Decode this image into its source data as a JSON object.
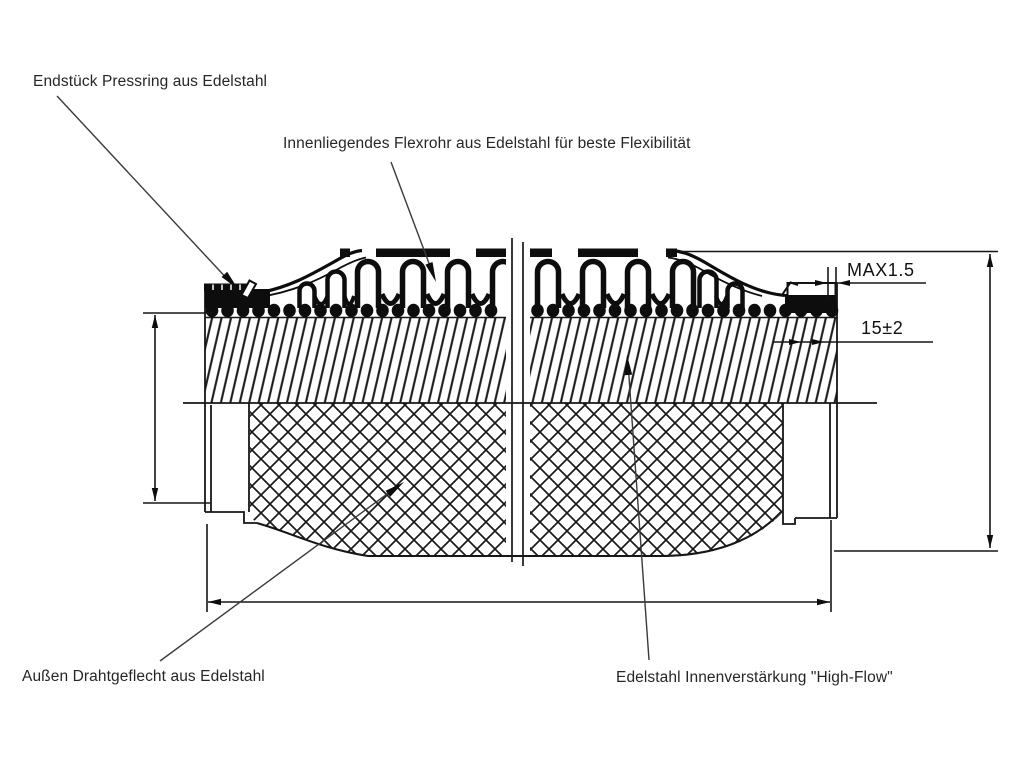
{
  "labels": {
    "pressring": "Endstück Pressring aus Edelstahl",
    "flexrohr": "Innenliegendes Flexrohr aus Edelstahl für beste Flexibilität",
    "drahtgeflecht": "Außen Drahtgeflecht aus Edelstahl",
    "innenverstaerkung": "Edelstahl Innenverstärkung \"High-Flow\""
  },
  "dimensions": {
    "liner_protrusion": "MAX1.5",
    "free_end_length": "15±2"
  },
  "colors": {
    "line": "#161616",
    "background": "#ffffff"
  }
}
